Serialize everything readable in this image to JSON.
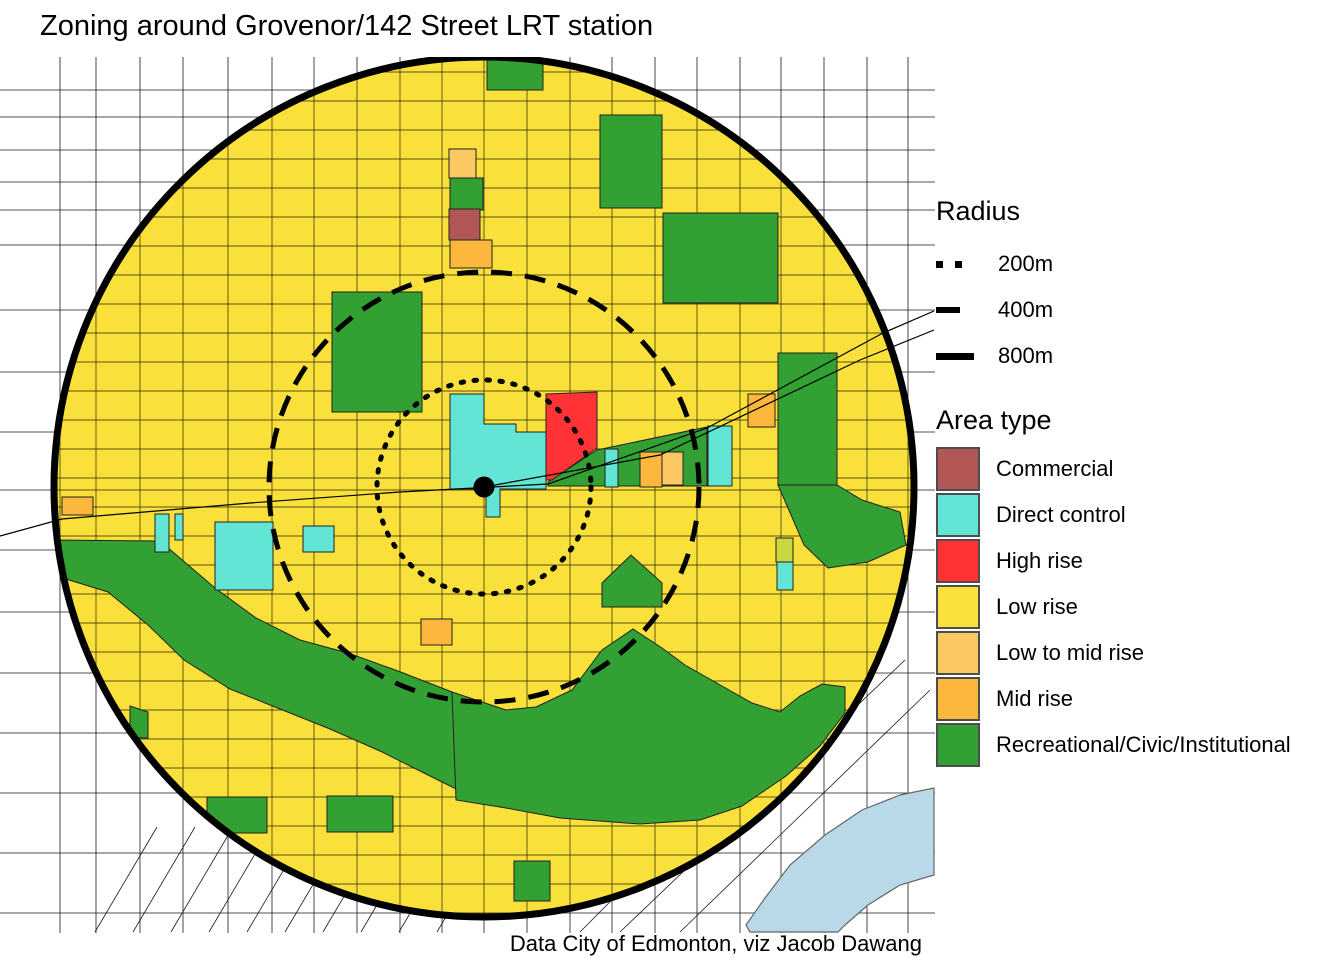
{
  "title": "Zoning around Grovenor/142 Street LRT station",
  "caption": "Data City of Edmonton, viz Jacob Dawang",
  "legend": {
    "radius": {
      "title": "Radius",
      "items": [
        {
          "label": "200m",
          "style": "dotted"
        },
        {
          "label": "400m",
          "style": "dashed"
        },
        {
          "label": "800m",
          "style": "solid"
        }
      ]
    },
    "area_type": {
      "title": "Area type",
      "items": [
        {
          "label": "Commercial",
          "color": "#B25755"
        },
        {
          "label": "Direct control",
          "color": "#62E5D5"
        },
        {
          "label": "High rise",
          "color": "#FF3236"
        },
        {
          "label": "Low rise",
          "color": "#F9E03A"
        },
        {
          "label": "Low to mid rise",
          "color": "#FBC862"
        },
        {
          "label": "Mid rise",
          "color": "#FCB73C"
        },
        {
          "label": "Recreational/Civic/Institutional",
          "color": "#33A033"
        }
      ]
    }
  },
  "map": {
    "frame": {
      "x": 0,
      "y": 57,
      "w": 935,
      "h": 876
    },
    "center": {
      "x": 484,
      "y": 487
    },
    "radii_px": {
      "r200": 107,
      "r400": 215,
      "r800": 430
    },
    "station_dot_radius": 10.5,
    "colors": {
      "low_rise": "#F9E03A",
      "recreational": "#33A033",
      "direct_control": "#62E5D5",
      "high_rise": "#FF3236",
      "mid_rise": "#FCB73C",
      "low_mid_rise": "#FBC862",
      "commercial": "#B25755",
      "other_olive": "#C8D93E",
      "water": "#B9D9E8",
      "water_stroke": "#666666",
      "street": "#000000"
    },
    "grid": {
      "v": [
        60,
        96,
        140,
        183,
        228,
        272,
        314,
        357,
        400,
        442,
        484,
        527,
        570,
        612,
        655,
        697,
        740,
        781,
        824,
        867,
        908
      ],
      "h_out": [
        90,
        117,
        150,
        182,
        210,
        245,
        310,
        372,
        432,
        490,
        550,
        612,
        673,
        733,
        793,
        853,
        913
      ],
      "h_in_start": 72,
      "h_in_step": 29,
      "h_in_end": 928,
      "diag_bl": [
        [
          95,
          932,
          157,
          827
        ],
        [
          133,
          932,
          195,
          827
        ],
        [
          171,
          932,
          233,
          827
        ],
        [
          209,
          932,
          271,
          827
        ],
        [
          247,
          932,
          309,
          827
        ],
        [
          285,
          932,
          347,
          827
        ],
        [
          323,
          932,
          385,
          827
        ],
        [
          361,
          932,
          423,
          827
        ],
        [
          399,
          932,
          461,
          827
        ],
        [
          437,
          932,
          499,
          827
        ]
      ],
      "diag_br": [
        [
          580,
          932,
          860,
          650
        ],
        [
          620,
          932,
          905,
          660
        ],
        [
          680,
          932,
          930,
          690
        ]
      ]
    },
    "rails": [
      [
        [
          0,
          536
        ],
        [
          62,
          519
        ],
        [
          250,
          503
        ],
        [
          400,
          492
        ],
        [
          548,
          484
        ],
        [
          707,
          428
        ],
        [
          883,
          333
        ],
        [
          934,
          311
        ]
      ],
      [
        [
          484,
          487
        ],
        [
          660,
          455
        ],
        [
          860,
          360
        ],
        [
          934,
          330
        ]
      ]
    ],
    "water": [
      [
        746,
        925
      ],
      [
        765,
        898
      ],
      [
        790,
        865
      ],
      [
        825,
        835
      ],
      [
        862,
        810
      ],
      [
        900,
        795
      ],
      [
        934,
        788
      ],
      [
        934,
        875
      ],
      [
        900,
        885
      ],
      [
        868,
        905
      ],
      [
        845,
        925
      ],
      [
        838,
        932
      ],
      [
        750,
        932
      ]
    ],
    "zones": [
      {
        "type": "recreational",
        "rect": [
          332,
          292,
          90,
          120
        ]
      },
      {
        "type": "recreational",
        "rect": [
          487,
          60,
          56,
          30
        ]
      },
      {
        "type": "recreational",
        "rect": [
          600,
          115,
          62,
          93
        ]
      },
      {
        "type": "recreational",
        "rect": [
          663,
          213,
          115,
          90
        ]
      },
      {
        "type": "recreational",
        "rect": [
          778,
          353,
          59,
          132
        ]
      },
      {
        "type": "recreational",
        "rect": [
          450,
          178,
          33,
          32
        ]
      },
      {
        "type": "recreational",
        "poly": [
          [
            778,
            485
          ],
          [
            837,
            485
          ],
          [
            862,
            500
          ],
          [
            900,
            512
          ],
          [
            906,
            545
          ],
          [
            868,
            562
          ],
          [
            828,
            568
          ],
          [
            804,
            545
          ],
          [
            788,
            508
          ]
        ]
      },
      {
        "type": "recreational",
        "poly": [
          [
            602,
            583
          ],
          [
            631,
            555
          ],
          [
            662,
            583
          ],
          [
            662,
            607
          ],
          [
            602,
            607
          ]
        ]
      },
      {
        "type": "recreational",
        "poly": [
          [
            54,
            540
          ],
          [
            160,
            541
          ],
          [
            215,
            588
          ],
          [
            256,
            618
          ],
          [
            300,
            640
          ],
          [
            348,
            653
          ],
          [
            398,
            671
          ],
          [
            452,
            692
          ],
          [
            462,
            700
          ],
          [
            462,
            792
          ],
          [
            430,
            776
          ],
          [
            380,
            751
          ],
          [
            330,
            729
          ],
          [
            280,
            709
          ],
          [
            230,
            689
          ],
          [
            184,
            660
          ],
          [
            148,
            625
          ],
          [
            108,
            592
          ],
          [
            56,
            576
          ]
        ]
      },
      {
        "type": "recreational",
        "poly": [
          [
            452,
            692
          ],
          [
            506,
            710
          ],
          [
            536,
            707
          ],
          [
            572,
            690
          ],
          [
            602,
            650
          ],
          [
            633,
            629
          ],
          [
            662,
            648
          ],
          [
            685,
            665
          ],
          [
            722,
            686
          ],
          [
            752,
            703
          ],
          [
            780,
            712
          ],
          [
            800,
            696
          ],
          [
            822,
            684
          ],
          [
            845,
            687
          ],
          [
            845,
            713
          ],
          [
            820,
            746
          ],
          [
            786,
            776
          ],
          [
            742,
            806
          ],
          [
            700,
            820
          ],
          [
            640,
            824
          ],
          [
            560,
            818
          ],
          [
            506,
            808
          ],
          [
            456,
            800
          ]
        ]
      },
      {
        "type": "recreational",
        "poly": [
          [
            130,
            706
          ],
          [
            148,
            712
          ],
          [
            148,
            738
          ],
          [
            130,
            738
          ]
        ]
      },
      {
        "type": "recreational",
        "rect": [
          207,
          797,
          60,
          36
        ]
      },
      {
        "type": "recreational",
        "rect": [
          327,
          796,
          66,
          36
        ]
      },
      {
        "type": "recreational",
        "rect": [
          514,
          861,
          36,
          40
        ]
      },
      {
        "type": "recreational",
        "poly": [
          [
            548,
            482
          ],
          [
            597,
            450
          ],
          [
            707,
            427
          ],
          [
            707,
            486
          ],
          [
            548,
            486
          ]
        ]
      },
      {
        "type": "direct_control",
        "poly": [
          [
            450,
            394
          ],
          [
            484,
            394
          ],
          [
            484,
            424
          ],
          [
            516,
            424
          ],
          [
            516,
            432
          ],
          [
            546,
            432
          ],
          [
            546,
            489
          ],
          [
            500,
            489
          ],
          [
            500,
            517
          ],
          [
            486,
            517
          ],
          [
            486,
            489
          ],
          [
            450,
            489
          ]
        ]
      },
      {
        "type": "direct_control",
        "rect": [
          708,
          426,
          24,
          60
        ]
      },
      {
        "type": "direct_control",
        "rect": [
          605,
          449,
          13,
          38
        ]
      },
      {
        "type": "direct_control",
        "rect": [
          155,
          514,
          14,
          38
        ]
      },
      {
        "type": "direct_control",
        "rect": [
          175,
          514,
          8,
          26
        ]
      },
      {
        "type": "direct_control",
        "rect": [
          215,
          522,
          58,
          68
        ]
      },
      {
        "type": "direct_control",
        "rect": [
          303,
          526,
          31,
          26
        ]
      },
      {
        "type": "direct_control",
        "rect": [
          777,
          559,
          16,
          31
        ]
      },
      {
        "type": "high_rise",
        "poly": [
          [
            546,
            394
          ],
          [
            597,
            392
          ],
          [
            597,
            448
          ],
          [
            552,
            480
          ],
          [
            546,
            480
          ]
        ]
      },
      {
        "type": "mid_rise",
        "rect": [
          748,
          394,
          27,
          33
        ]
      },
      {
        "type": "mid_rise",
        "rect": [
          640,
          452,
          22,
          35
        ]
      },
      {
        "type": "mid_rise",
        "rect": [
          450,
          240,
          42,
          28
        ]
      },
      {
        "type": "mid_rise",
        "rect": [
          62,
          497,
          31,
          18
        ]
      },
      {
        "type": "mid_rise",
        "rect": [
          421,
          619,
          31,
          26
        ]
      },
      {
        "type": "low_mid_rise",
        "rect": [
          449,
          149,
          27,
          29
        ]
      },
      {
        "type": "low_mid_rise",
        "rect": [
          662,
          452,
          21,
          33
        ]
      },
      {
        "type": "commercial",
        "rect": [
          449,
          209,
          31,
          31
        ]
      },
      {
        "type": "other_olive",
        "rect": [
          776,
          538,
          17,
          24
        ]
      }
    ]
  }
}
